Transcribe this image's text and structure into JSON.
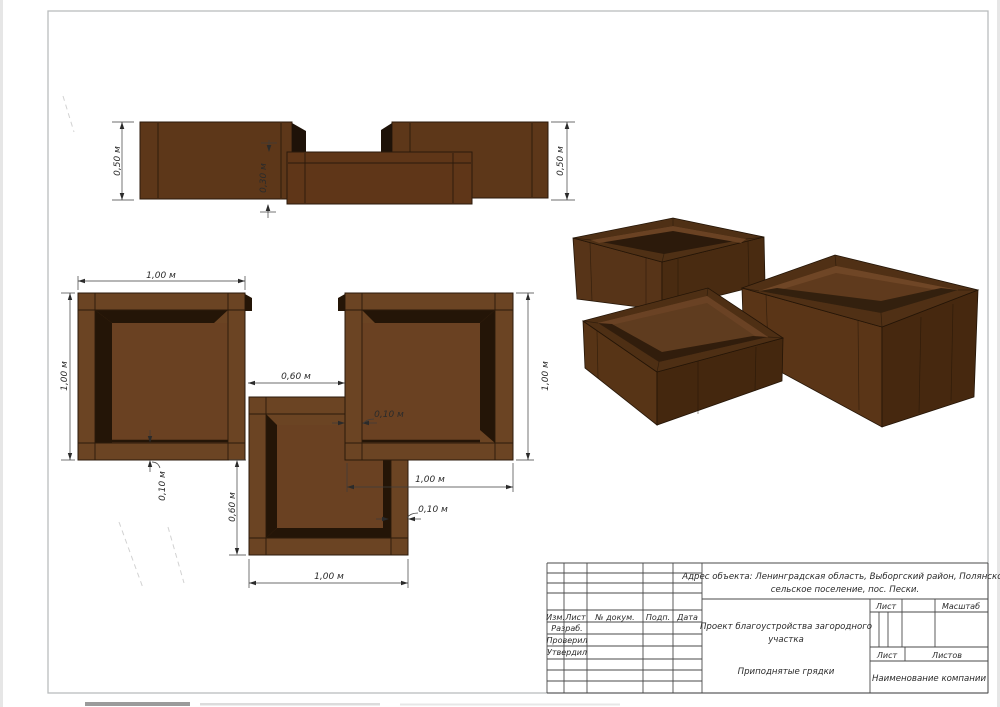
{
  "elevation": {
    "dim_left": "0,50 м",
    "dim_middle": "0,30 м",
    "dim_right": "0,50 м"
  },
  "plan": {
    "dim_top_width": "1,00 м",
    "dim_left_depth": "1,00 м",
    "dim_gap": "0,60 м",
    "dim_right_depth": "1,00 м",
    "dim_right_width": "1,00 м",
    "dim_middle_offset": "0,60 м",
    "dim_bottom_width": "1,00 м",
    "dim_wall_left": "0,10 м",
    "dim_wall_right": "0,10 м",
    "dim_wall_middle": "0,10 м"
  },
  "title_block": {
    "address_line1": "Адрес объекта: Ленинградская область, Выборгский район, Полянское",
    "address_line2": "сельское поселение, пос. Пески.",
    "project_line1": "Проект благоустройства загородного",
    "project_line2": "участка",
    "drawing_title": "Приподнятые грядки",
    "company": "Наименование компании",
    "col_izm": "Изм.",
    "col_list": "Лист",
    "col_doc": "№  докум.",
    "col_podp": "Подп.",
    "col_data": "Дата",
    "row_razrab": "Разраб.",
    "row_proveril": "Проверил",
    "row_utverdil": "Утвердил",
    "sheet_label": "Лист",
    "scale_label": "Масштаб",
    "sheet_label2": "Лист",
    "sheets_label": "Листов"
  },
  "colors": {
    "wood_face": "#5d3719",
    "wood_face_dark": "#46280f",
    "wood_frame": "#6b4423",
    "wood_shadow": "#241507",
    "rim_top": "#4f3015"
  }
}
